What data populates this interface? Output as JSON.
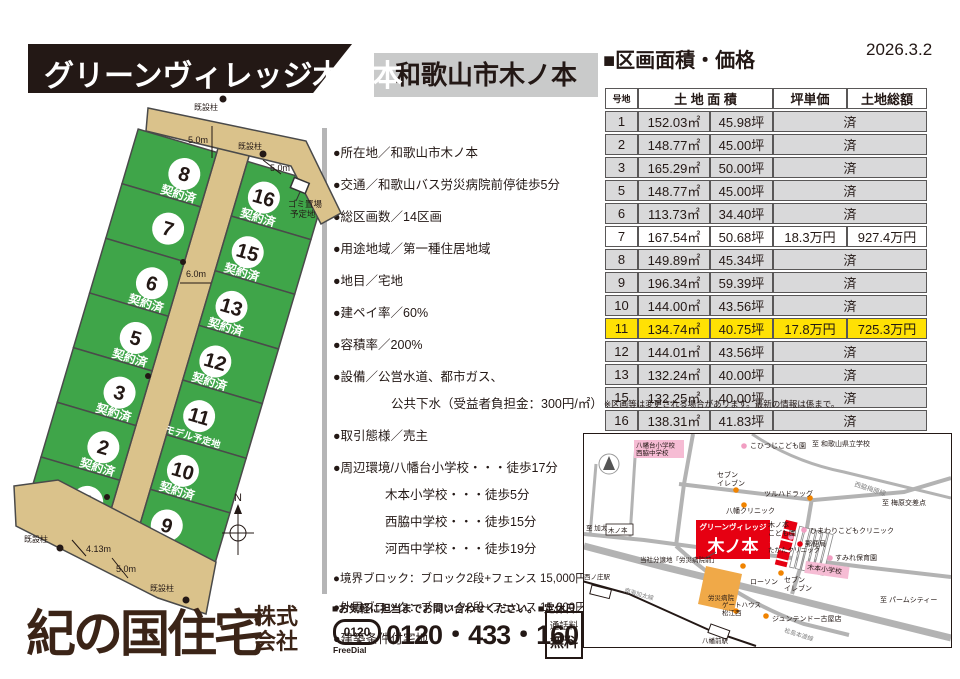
{
  "banner": {
    "title": "グリーンヴィレッジ木ノ本"
  },
  "location_box": {
    "text": "和歌山市木ノ本"
  },
  "price_section": {
    "heading": "■区画面積・価格",
    "date": "2026.3.2",
    "headers": {
      "lot": "号地",
      "area": "土 地 面 積",
      "unit_price": "坪単価",
      "total_price": "土地総額"
    },
    "sold_label": "済",
    "rows": [
      {
        "lot": "1",
        "m2": "152.03㎡",
        "tsubo": "45.98坪",
        "status": "sold"
      },
      {
        "lot": "2",
        "m2": "148.77㎡",
        "tsubo": "45.00坪",
        "status": "sold"
      },
      {
        "lot": "3",
        "m2": "165.29㎡",
        "tsubo": "50.00坪",
        "status": "sold"
      },
      {
        "lot": "5",
        "m2": "148.77㎡",
        "tsubo": "45.00坪",
        "status": "sold"
      },
      {
        "lot": "6",
        "m2": "113.73㎡",
        "tsubo": "34.40坪",
        "status": "sold"
      },
      {
        "lot": "7",
        "m2": "167.54㎡",
        "tsubo": "50.68坪",
        "status": "available",
        "unit_price": "18.3万円",
        "total_price": "927.4万円"
      },
      {
        "lot": "8",
        "m2": "149.89㎡",
        "tsubo": "45.34坪",
        "status": "sold"
      },
      {
        "lot": "9",
        "m2": "196.34㎡",
        "tsubo": "59.39坪",
        "status": "sold"
      },
      {
        "lot": "10",
        "m2": "144.00㎡",
        "tsubo": "43.56坪",
        "status": "sold"
      },
      {
        "lot": "11",
        "m2": "134.74㎡",
        "tsubo": "40.75坪",
        "status": "available",
        "highlight": true,
        "unit_price": "17.8万円",
        "total_price": "725.3万円"
      },
      {
        "lot": "12",
        "m2": "144.01㎡",
        "tsubo": "43.56坪",
        "status": "sold"
      },
      {
        "lot": "13",
        "m2": "132.24㎡",
        "tsubo": "40.00坪",
        "status": "sold"
      },
      {
        "lot": "15",
        "m2": "132.25㎡",
        "tsubo": "40.00坪",
        "status": "sold"
      },
      {
        "lot": "16",
        "m2": "138.31㎡",
        "tsubo": "41.83坪",
        "status": "sold"
      }
    ],
    "note": "※区画等は変更される場合があります。最新の情報は係まで。"
  },
  "details": {
    "items": [
      {
        "text": "●所在地／和歌山市木ノ本",
        "first": true
      },
      {
        "text": "●交通／和歌山バス労災病院前停徒歩5分"
      },
      {
        "text": "●総区画数／14区画"
      },
      {
        "text": "●用途地域／第一種住居地域"
      },
      {
        "text": "●地目／宅地"
      },
      {
        "text": "●建ペイ率／60%"
      },
      {
        "text": "●容積率／200%"
      },
      {
        "text": "●設備／公営水道、都市ガス、"
      },
      {
        "text": "公共下水（受益者負担金：300円/㎡）",
        "indent": 58
      },
      {
        "text": "●取引態様／売主"
      },
      {
        "text": "●周辺環境/八幡台小学校・・・徒歩17分"
      },
      {
        "text": "木本小学校・・・徒歩5分",
        "indent": 52
      },
      {
        "text": "西脇中学校・・・徒歩15分",
        "indent": 52
      },
      {
        "text": "河西中学校・・・徒歩19分",
        "indent": 52
      },
      {
        "text": "●境界ブロック：ブロック2段+フェンス 15,000円/m(税抜)",
        "small": true
      },
      {
        "text": "●外周ブロック：ブロック2段+フェンス 15,000円/m(税抜)",
        "small": true
      },
      {
        "text": "●建築条件付宅地"
      }
    ]
  },
  "site_plan": {
    "sold_label": "契約済",
    "model_label": "モデル予定地",
    "lots_left": [
      {
        "no": "8",
        "label": "契約済"
      },
      {
        "no": "7",
        "label": ""
      },
      {
        "no": "6",
        "label": "契約済"
      },
      {
        "no": "5",
        "label": "契約済"
      },
      {
        "no": "3",
        "label": "契約済"
      },
      {
        "no": "2",
        "label": "契約済"
      },
      {
        "no": "1",
        "label": "契約済"
      }
    ],
    "lots_right": [
      {
        "no": "16",
        "label": "契約済"
      },
      {
        "no": "15",
        "label": "契約済"
      },
      {
        "no": "13",
        "label": "契約済"
      },
      {
        "no": "12",
        "label": "契約済"
      },
      {
        "no": "11",
        "label": "モデル予定地"
      },
      {
        "no": "10",
        "label": "契約済"
      },
      {
        "no": "9",
        "label": "契約済"
      }
    ],
    "annotations": {
      "pole": "既設柱",
      "garbage1": "ゴミ置場",
      "garbage2": "予定地",
      "w_top": "5.0m",
      "w_tail": "5.0m",
      "w_main": "6.0m",
      "w_b1": "4.13m",
      "w_b2": "5.0m",
      "compass_n": "N"
    },
    "colors": {
      "lot_green": "#3fa549",
      "road_tan": "#dac28b",
      "line": "#4a4a4a"
    }
  },
  "company": {
    "name": "紀の国住宅",
    "suffix_line1": "株式",
    "suffix_line2": "会社",
    "contact_line": "■お気軽に担当までお問い合わせください。■定休日／水曜日",
    "freedial_number": "0120",
    "freedial_label": "FreeDial",
    "phone": "0120・433・160",
    "tollfree_line1": "通話料",
    "tollfree_line2": "無料"
  },
  "map": {
    "site_tab": "グリーンヴィレッジ",
    "site_name": "木ノ本",
    "colors": {
      "red": "#e60012",
      "pink": "#f6bcd4",
      "orange": "#f0a948",
      "road": "#b3b3b3"
    },
    "roads": [
      {
        "d": "M0,100 L60,106 L120,114 L200,123 L280,133 L367,143",
        "w": 4
      },
      {
        "d": "M0,112 L80,133 L190,160 L290,185 L367,204",
        "w": 7
      },
      {
        "d": "M109,0 L100,50 L92,112",
        "w": 4
      },
      {
        "d": "M92,112 Q150,165 220,190 L265,201",
        "w": 4
      },
      {
        "d": "M95,50 L230,66 L320,58 L367,44",
        "w": 4
      },
      {
        "d": "M168,0 Q210,28 260,38 L367,64",
        "w": 3
      },
      {
        "d": "M52,8 L46,103",
        "w": 3
      },
      {
        "d": "M12,30 L6,102",
        "w": 3
      },
      {
        "d": "M228,64 L216,135 L208,160",
        "w": 4
      }
    ],
    "railway": "M-2,147 L45,160 L125,196 L172,212",
    "stations": [
      {
        "x": 8,
        "y": 151,
        "rot": 14
      },
      {
        "x": 127,
        "y": 190,
        "rot": 20
      }
    ],
    "dots": [
      {
        "x": 152,
        "y": 56,
        "c": "#f08300"
      },
      {
        "x": 226,
        "y": 64,
        "c": "#f08300"
      },
      {
        "x": 160,
        "y": 71,
        "c": "#f08300"
      },
      {
        "x": 159,
        "y": 132,
        "c": "#f08300"
      },
      {
        "x": 197,
        "y": 139,
        "c": "#f08300"
      },
      {
        "x": 182,
        "y": 182,
        "c": "#f08300"
      },
      {
        "x": 152,
        "y": 177,
        "c": "#f08300"
      },
      {
        "x": 160,
        "y": 12,
        "c": "#f19ec2"
      },
      {
        "x": 207,
        "y": 103,
        "c": "#f19ec2"
      },
      {
        "x": 220,
        "y": 96,
        "c": "#f19ec2"
      },
      {
        "x": 246,
        "y": 124,
        "c": "#f19ec2"
      },
      {
        "x": 216,
        "y": 110,
        "c": "#e60012"
      }
    ],
    "labels": [
      {
        "t": "こひつじこども園",
        "x": 166,
        "y": 14,
        "fs": 7
      },
      {
        "t": "至 和歌山県立学校",
        "x": 228,
        "y": 12,
        "fs": 7
      },
      {
        "t": "セブン|イレブン",
        "x": 133,
        "y": 43,
        "fs": 7
      },
      {
        "t": "ツルハドラッグ",
        "x": 180,
        "y": 62,
        "fs": 7
      },
      {
        "t": "西脇梅原線",
        "x": 270,
        "y": 52,
        "fs": 6.5,
        "rot": 18,
        "c": "#808080"
      },
      {
        "t": "至 梅原交差点",
        "x": 298,
        "y": 71,
        "fs": 7
      },
      {
        "t": "八幡クリニック",
        "x": 142,
        "y": 79,
        "fs": 7
      },
      {
        "t": "至 加太",
        "x": 2,
        "y": 96,
        "fs": 6.5
      },
      {
        "t": "木ノ本|こども園",
        "x": 184,
        "y": 93,
        "fs": 7
      },
      {
        "t": "ひまわりこどもクリニック",
        "x": 226,
        "y": 99,
        "fs": 7
      },
      {
        "t": "郵便局",
        "x": 221,
        "y": 112,
        "fs": 7
      },
      {
        "t": "すみれ保育園",
        "x": 251,
        "y": 126,
        "fs": 7
      },
      {
        "t": "たかたクリニック",
        "x": 184,
        "y": 118,
        "fs": 6.5
      },
      {
        "t": "ローソン",
        "x": 166,
        "y": 150,
        "fs": 7
      },
      {
        "t": "当社分譲地「労災病院前」",
        "x": 56,
        "y": 128,
        "fs": 6.5
      },
      {
        "t": "セブン|イレブン",
        "x": 200,
        "y": 148,
        "fs": 7
      },
      {
        "t": "ゲートハウス|松江西",
        "x": 138,
        "y": 173,
        "fs": 6.5
      },
      {
        "t": "ジュンテンドー古屋店",
        "x": 188,
        "y": 187,
        "fs": 7
      },
      {
        "t": "至 パームシティー",
        "x": 296,
        "y": 168,
        "fs": 7
      },
      {
        "t": "南海加太線",
        "x": 40,
        "y": 158,
        "fs": 6,
        "rot": 16,
        "c": "#808080"
      },
      {
        "t": "松島本渡線",
        "x": 200,
        "y": 198,
        "fs": 6,
        "rot": 18,
        "c": "#808080"
      },
      {
        "t": "西ノ庄駅",
        "x": 0,
        "y": 145,
        "fs": 6.5
      },
      {
        "t": "八幡前駅",
        "x": 118,
        "y": 209,
        "fs": 6.5
      },
      {
        "t": "労災病院",
        "x": 124,
        "y": 166,
        "fs": 6.5
      }
    ],
    "pink_boxes": [
      {
        "t": "八幡台小学校|西脇中学校",
        "x": 50,
        "y": 6,
        "w": 50,
        "h": 18,
        "fs": 6.5
      },
      {
        "t": "木本小学校",
        "x": 222,
        "y": 127,
        "w": 44,
        "h": 12,
        "fs": 7,
        "rot": 8
      }
    ],
    "sign_box": {
      "t": "木ノ本",
      "x": 22,
      "y": 90,
      "w": 27,
      "h": 11,
      "fs": 6.5
    }
  }
}
